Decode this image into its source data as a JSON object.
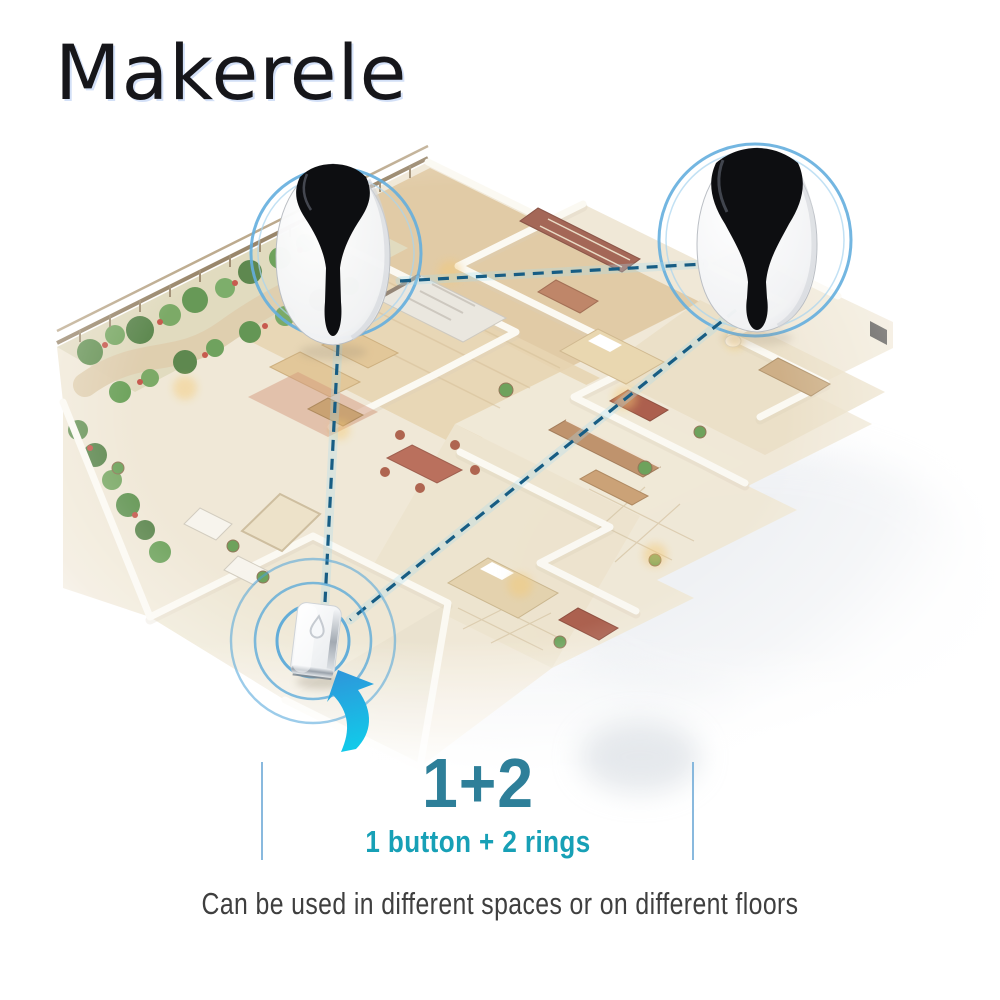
{
  "brand": {
    "logo_text": "Makerele"
  },
  "headline": {
    "title": "1+2",
    "subtitle": "1 button + 2 rings"
  },
  "caption": {
    "text": "Can be used in different spaces or on different floors"
  },
  "diagram": {
    "illustration": "isometric-apartment-floorplan",
    "icons": {
      "receiver_left": "doorbell-receiver-icon",
      "receiver_right": "doorbell-receiver-icon",
      "button": "doorbell-button-icon",
      "arrow": "curved-arrow-icon",
      "ripples": "signal-ripples-icon",
      "connections": "wireless-link-dashed-line"
    }
  },
  "colors": {
    "logo": "#16161a",
    "logo_accent": "#aec6f0",
    "title": "#2e7f99",
    "subtitle": "#17a0b6",
    "caption": "#3f3f3f",
    "divider": "#74add8",
    "connection_line": "#175d84",
    "connection_glow": "#a8dcee",
    "ripple_ring": "#4aa2d8",
    "highlight_ring": "#64aede",
    "arrow_start": "#2f94da",
    "arrow_end": "#12c9e9",
    "floor": "#f0e7d4",
    "wood_floor": "#dcc094",
    "wall": "#fbf9f2",
    "furniture_accent": "#b4624d",
    "greenery": "#5a8a47"
  }
}
